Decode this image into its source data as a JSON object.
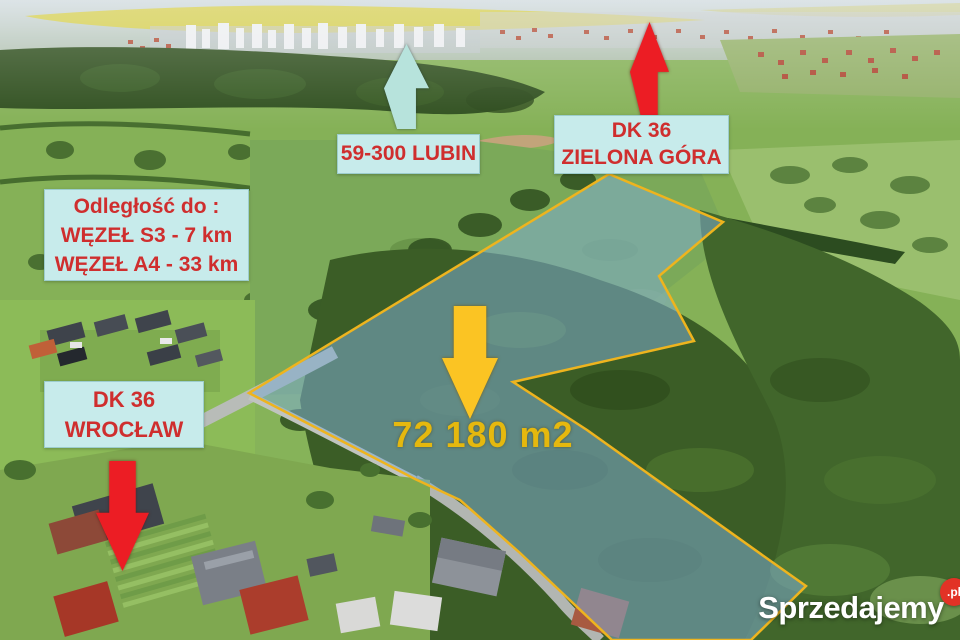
{
  "annotations": {
    "lubin": {
      "label": "59-300 LUBIN",
      "arrow_direction": "up"
    },
    "zielona_gora": {
      "route": "DK 36",
      "city": "ZIELONA GÓRA",
      "arrow_direction": "up"
    },
    "distances": {
      "title": "Odległość do :",
      "s3": "WĘZEŁ S3 - 7 km",
      "a4": "WĘZEŁ A4 - 33 km"
    },
    "wroclaw": {
      "route": "DK 36",
      "city": "WROCŁAW",
      "arrow_direction": "down"
    },
    "plot": {
      "area": "72 180 m2"
    }
  },
  "watermark": {
    "brand": "Sprzedajemy",
    "suffix": ".pl"
  },
  "colors": {
    "label_box_bg": "#c7ebeb",
    "label_text": "#cf2e2e",
    "plot_outline": "#eeb41e",
    "plot_fill": "rgba(125,172,208,0.55)",
    "area_text": "#e5b80e",
    "arrow_red": "#ec1d24",
    "arrow_cyan": "#b7e3dc",
    "arrow_yellow": "#fbc423",
    "watermark_badge": "#e23226"
  }
}
